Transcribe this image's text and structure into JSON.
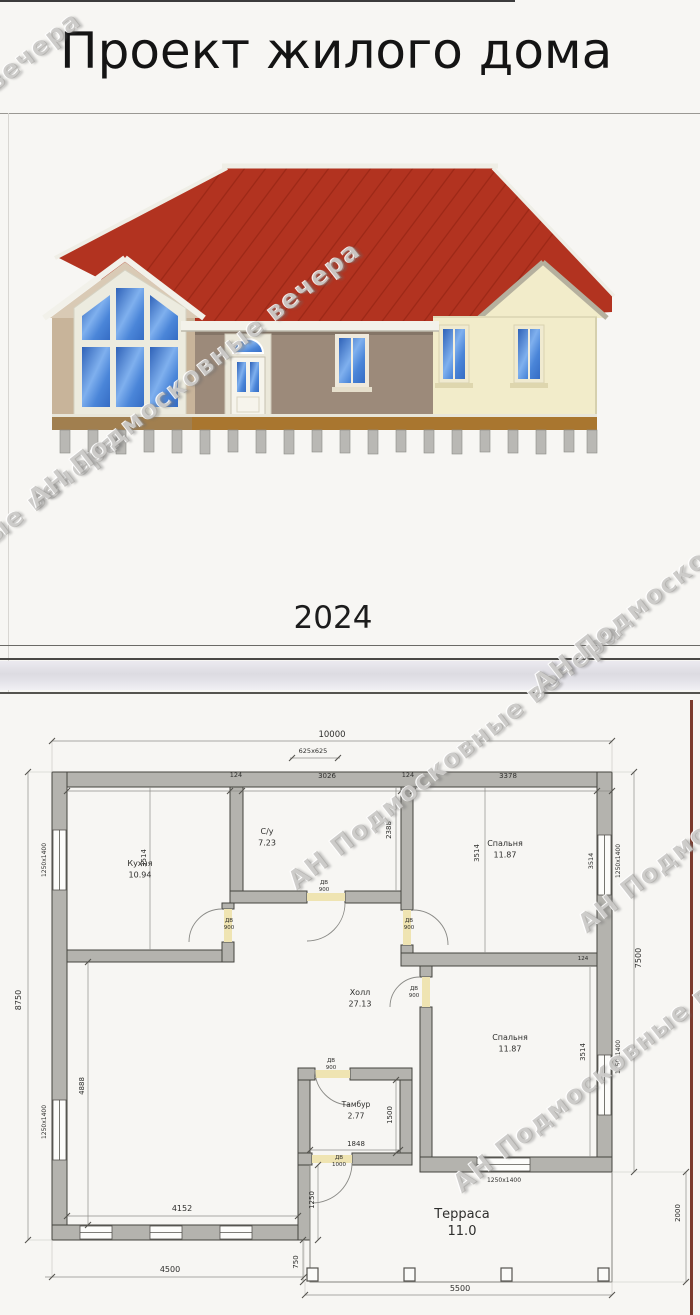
{
  "header": {
    "title": "Проект жилого дома",
    "year": "2024"
  },
  "watermark": {
    "text": "АН Подмосковные вечера",
    "positions": [
      {
        "x": -85,
        "y": 145
      },
      {
        "x": -45,
        "y": 565
      },
      {
        "x": 195,
        "y": 375
      },
      {
        "x": 455,
        "y": 757
      },
      {
        "x": 620,
        "y": 1060
      },
      {
        "x": 700,
        "y": 560
      },
      {
        "x": 745,
        "y": 800
      }
    ]
  },
  "house": {
    "roof_color": "#b23320",
    "left_wall_color": "#c8b49a",
    "left_gable_color": "#d9cab5",
    "middle_wall_color": "#9c8a7a",
    "right_wall_color": "#f2ecca",
    "skirt_color": "#a9762f"
  },
  "plan": {
    "dimensions": [
      {
        "t": "10000",
        "x": 332,
        "y": 737,
        "s": 8.5
      },
      {
        "t": "625х625",
        "x": 313,
        "y": 753,
        "s": 6.5
      },
      {
        "t": "124",
        "x": 236,
        "y": 777,
        "s": 6.5
      },
      {
        "t": "3026",
        "x": 327,
        "y": 778,
        "s": 7
      },
      {
        "t": "124",
        "x": 408,
        "y": 777,
        "s": 6.5
      },
      {
        "t": "3378",
        "x": 508,
        "y": 778,
        "s": 7
      },
      {
        "t": "8750",
        "x": 21,
        "y": 1000,
        "r": -90,
        "s": 8
      },
      {
        "t": "1250х1400",
        "x": 46,
        "y": 860,
        "r": -90,
        "s": 6
      },
      {
        "t": "3514",
        "x": 146,
        "y": 858,
        "r": -90,
        "s": 7
      },
      {
        "t": "2388",
        "x": 391,
        "y": 830,
        "r": -90,
        "s": 7
      },
      {
        "t": "3514",
        "x": 479,
        "y": 853,
        "r": -90,
        "s": 7
      },
      {
        "t": "3514",
        "x": 593,
        "y": 861,
        "r": -90,
        "s": 6.5
      },
      {
        "t": "1250х1400",
        "x": 620,
        "y": 861,
        "r": -90,
        "s": 6
      },
      {
        "t": "7500",
        "x": 641,
        "y": 958,
        "r": -90,
        "s": 8
      },
      {
        "t": "124",
        "x": 583,
        "y": 960,
        "s": 5.5
      },
      {
        "t": "3514",
        "x": 585,
        "y": 1052,
        "r": -90,
        "s": 7
      },
      {
        "t": "1250х1400",
        "x": 620,
        "y": 1057,
        "r": -90,
        "s": 6
      },
      {
        "t": "4888",
        "x": 84,
        "y": 1086,
        "r": -90,
        "s": 7
      },
      {
        "t": "1250х1400",
        "x": 46,
        "y": 1122,
        "r": -90,
        "s": 6
      },
      {
        "t": "1848",
        "x": 356,
        "y": 1146,
        "s": 7
      },
      {
        "t": "1500",
        "x": 392,
        "y": 1115,
        "r": -90,
        "s": 7
      },
      {
        "t": "1250",
        "x": 314,
        "y": 1200,
        "r": -90,
        "s": 7
      },
      {
        "t": "750",
        "x": 298,
        "y": 1262,
        "r": -90,
        "s": 7
      },
      {
        "t": "4152",
        "x": 182,
        "y": 1211,
        "s": 8
      },
      {
        "t": "4500",
        "x": 170,
        "y": 1272,
        "s": 8
      },
      {
        "t": "5500",
        "x": 460,
        "y": 1291,
        "s": 8
      },
      {
        "t": "2000",
        "x": 680,
        "y": 1213,
        "r": -90,
        "s": 7
      },
      {
        "t": "1250х1400",
        "x": 504,
        "y": 1182,
        "s": 6
      }
    ],
    "rooms": [
      {
        "name": "Кухня",
        "area": "10.94",
        "x": 140,
        "y": 866
      },
      {
        "name": "С/у",
        "area": "7.23",
        "x": 267,
        "y": 834
      },
      {
        "name": "Спальня",
        "area": "11.87",
        "x": 505,
        "y": 846
      },
      {
        "name": "Холл",
        "area": "27.13",
        "x": 360,
        "y": 995
      },
      {
        "name": "Спальня",
        "area": "11.87",
        "x": 510,
        "y": 1040
      },
      {
        "name": "Тамбур",
        "area": "2.77",
        "x": 356,
        "y": 1107,
        "s": 7.5
      },
      {
        "name": "Терраса",
        "area": "11.0",
        "x": 462,
        "y": 1218,
        "s": 13,
        "dy": 17
      }
    ],
    "doors": [
      {
        "label": "ДВ",
        "size": "900",
        "x": 229,
        "y": 922
      },
      {
        "label": "ДВ",
        "size": "900",
        "x": 324,
        "y": 884
      },
      {
        "label": "ДВ",
        "size": "900",
        "x": 409,
        "y": 922
      },
      {
        "label": "ДВ",
        "size": "900",
        "x": 414,
        "y": 990
      },
      {
        "label": "ДВ",
        "size": "900",
        "x": 331,
        "y": 1062
      },
      {
        "label": "ДВ",
        "size": "1000",
        "x": 339,
        "y": 1159
      }
    ]
  }
}
